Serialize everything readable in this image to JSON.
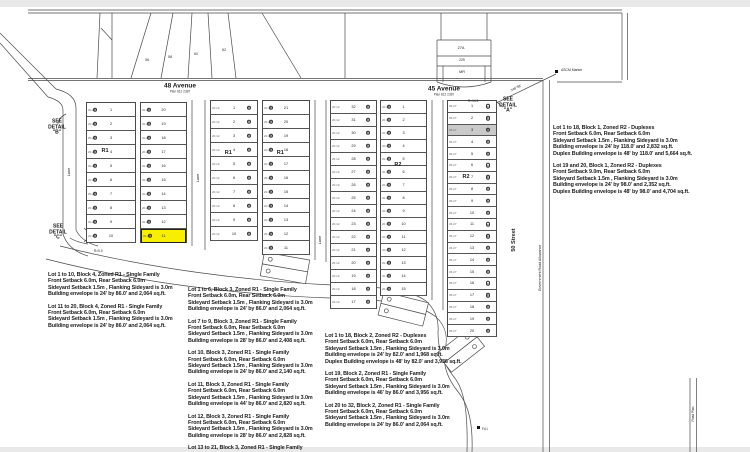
{
  "streets": {
    "avenue_48": {
      "name": "48 Avenue",
      "plan": "Plan 812 2387"
    },
    "avenue_45": {
      "name": "45 Avenue",
      "plan": "Plan 812 2387"
    },
    "street_50": "50 Street",
    "road_allowance": "Government Road Allowance",
    "lane": "Lane"
  },
  "details": {
    "a": [
      "SEE",
      "DETAIL",
      "\"A\""
    ],
    "b": [
      "SEE",
      "DETAIL",
      "\"B\""
    ],
    "c": [
      "SEE",
      "DETAIL",
      "\"C\""
    ]
  },
  "survey_marker": "ASCM Marker",
  "bearing": "146°58'",
  "radius_labels": [
    "R=14.5",
    "R=9.0"
  ],
  "parcel_labels": [
    "27A",
    "229",
    "MR"
  ],
  "adjacent_lots": [
    "56",
    "58",
    "60",
    "62"
  ],
  "misc_labels": [
    "Fd.I.",
    "Road Plan"
  ],
  "highlight_color": "#f7ee00",
  "blocks": [
    {
      "id": "block1",
      "zone": "R2",
      "columns": [
        {
          "lots": [
            "1",
            "2",
            "3",
            "4",
            "5",
            "6",
            "7",
            "8",
            "9",
            "10",
            "11",
            "12",
            "13",
            "14",
            "15",
            "16",
            "17",
            "18",
            "19",
            "20"
          ],
          "dim": "36.27",
          "circle": "right"
        }
      ],
      "shaded": {
        "col": 0,
        "row": 2
      }
    },
    {
      "id": "block2",
      "zone": "R2",
      "columns": [
        {
          "lots": [
            "32",
            "31",
            "30",
            "29",
            "28",
            "27",
            "26",
            "25",
            "24",
            "23",
            "22",
            "21",
            "20",
            "19",
            "18",
            "17"
          ],
          "dim": "20.12",
          "circle": "right"
        },
        {
          "lots": [
            "1",
            "2",
            "3",
            "4",
            "5",
            "6",
            "7",
            "8",
            "9",
            "10",
            "11",
            "12",
            "13",
            "14",
            "15"
          ],
          "dim": "20.12",
          "circle": "left"
        }
      ]
    },
    {
      "id": "block3",
      "zone": "R1",
      "columns": [
        {
          "lots": [
            "1",
            "2",
            "3",
            "4",
            "5",
            "6",
            "7",
            "8",
            "9",
            "10"
          ],
          "dim": "20.12",
          "circle": "right"
        },
        {
          "lots": [
            "21",
            "20",
            "19",
            "18",
            "17",
            "16",
            "15",
            "14",
            "13",
            "12",
            "11"
          ],
          "dim": "20.12",
          "circle": "left"
        }
      ]
    },
    {
      "id": "block4",
      "zone": "R1",
      "columns": [
        {
          "lots": [
            "1",
            "2",
            "3",
            "4",
            "5",
            "6",
            "7",
            "8",
            "9",
            "10"
          ],
          "dim": "20.27",
          "circle": "left"
        },
        {
          "lots": [
            "20",
            "19",
            "18",
            "17",
            "16",
            "15",
            "14",
            "13",
            "12",
            "11"
          ],
          "dim": "20.27",
          "circle": "left"
        }
      ],
      "highlight": {
        "col": 1,
        "row": 9
      }
    }
  ],
  "notes": {
    "block4": [
      [
        "Lot 1 to 10, Block 4, Zoned R1 - Single Family",
        "Front Setback 6.0m, Rear Setback 6.0m",
        "Sideyard Setback 1.5m , Flanking Sideyard is 3.0m",
        "Building envelope is 24' by 86.0' and 2,064 sq.ft."
      ],
      [
        "Lot 11 to 20, Block 4, Zoned R1 - Single Family",
        "Front Setback 6.0m, Rear Setback 6.0m",
        "Sideyard Setback 1.5m , Flanking Sideyard is 3.0m",
        "Building envelope is 24' by 86.0' and 2,064 sq.ft."
      ]
    ],
    "block3": [
      [
        "Lot 1 to 6, Block 3, Zoned R1 - Single Family",
        "Front Setback 6.0m, Rear Setback 6.0m",
        "Sideyard Setback 1.5m , Flanking Sideyard is 3.0m",
        "Building envelope is 24' by 86.0' and 2,064 sq.ft."
      ],
      [
        "Lot 7 to 9, Block 3, Zoned R1 - Single Family",
        "Front Setback 6.0m, Rear Setback 6.0m",
        "Sideyard Setback 1.5m , Flanking Sideyard is 3.0m",
        "Building envelope is 28' by 86.0' and 2,408 sq.ft."
      ],
      [
        "Lot 10, Block 3, Zoned R1 - Single Family",
        "Front Setback 6.0m, Rear Setback 6.0m",
        "Sideyard Setback 1.5m , Flanking Sideyard is 3.0m",
        "Building envelope is 24' by 86.0' and 2,140 sq.ft."
      ],
      [
        "Lot 11, Block 3, Zoned R1 - Single Family",
        "Front Setback 6.0m, Rear Setback 6.0m",
        "Sideyard Setback 1.5m , Flanking Sideyard is 3.0m",
        "Building envelope is 44' by 86.0' and 2,820 sq.ft."
      ],
      [
        "Lot 12, Block 3, Zoned R1 - Single Family",
        "Front Setback 6.0m, Rear Setback 6.0m",
        "Sideyard Setback 1.5m , Flanking Sideyard is 3.0m",
        "Building envelope is 28' by 86.0' and 2,828 sq.ft."
      ],
      [
        "Lot 13 to 21, Block 3, Zoned R1 - Single Family",
        "Front Setback 6.0m, Rear Setback 6.0m",
        "Sideyard Setback 1.5m , Flanking Sideyard is 3.0m"
      ]
    ],
    "block2": [
      [
        "Lot 1 to 18, Block 2, Zoned R2 - Duplexes",
        "Front Setback 6.0m, Rear Setback 6.0m",
        "Sideyard Setback 1.5m , Flanking Sideyard is 3.0m",
        "Building envelope is 24' by 82.0' and 1,968 sq.ft.",
        "Duplex Building envelope is 48' by 82.0' and 3,936 sq.ft."
      ],
      [
        "Lot 19, Block 2, Zoned R1 - Single Family",
        "Front Setback 6.0m, Rear Setback 6.0m",
        "Sideyard Setback 1.5m , Flanking Sideyard is 3.0m",
        "Building envelope is 46' by 86.0' and 3,956 sq.ft."
      ],
      [
        "Lot 20 to 32, Block 2, Zoned R1 - Single Family",
        "Front Setback 6.0m, Rear Setback 6.0m",
        "Sideyard Setback 1.5m , Flanking Sideyard is 3.0m",
        "Building envelope is 24' by 86.0' and 2,064 sq.ft."
      ]
    ],
    "block1": [
      [
        "Lot 1 to 18, Block 1, Zoned R2 - Duplexes",
        "Front Setback 6.0m, Rear Setback 6.0m",
        "Sideyard Setback 1.5m , Flanking Sideyard is 3.0m",
        "Building envelope is 24' by 118.0' and 2,832 sq.ft.",
        "Duplex Building envelope is 48' by 118.0' and 5,664 sq.ft."
      ],
      [
        "Lot 19 and 20, Block 1, Zoned R2 - Duplexes",
        "Front Setback 9.0m, Rear Setback 6.0m",
        "Sideyard Setback 1.5m , Flanking Sideyard is 3.0m",
        "Building envelope is 24' by 98.0' and 2,352 sq.ft.",
        "Duplex Building envelope is 48' by 98.0' and 4,704 sq.ft."
      ]
    ]
  }
}
